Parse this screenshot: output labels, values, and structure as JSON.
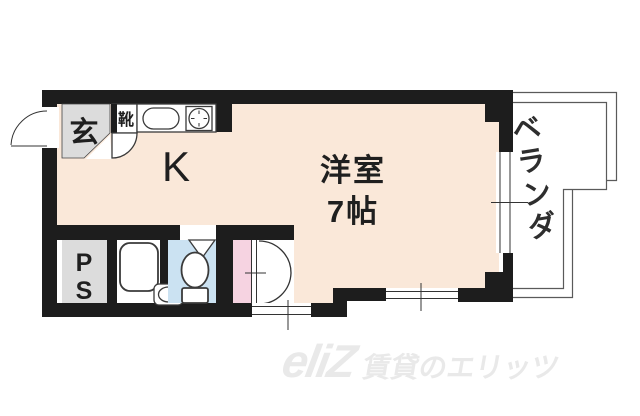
{
  "floor_plan": {
    "labels": {
      "entrance": "玄",
      "shoe_cabinet": "靴",
      "kitchen": "K",
      "main_room_name": "洋室",
      "main_room_size": "7帖",
      "veranda": "ベランダ",
      "pipe_space": {
        "line1": "P",
        "line2": "S"
      }
    },
    "colors": {
      "wall": "#1d1d1d",
      "floor": "#fae8d9",
      "service_gray": "#dcdcdc",
      "toilet_blue": "#cbe2f2",
      "closet_pink": "#f6d3e1",
      "outline": "#333333",
      "veranda_line": "#5a5a5a",
      "watermark": "#e9e9e9"
    },
    "icons": {
      "entrance_door": "quarter-arc-swing",
      "shoe_cabinet_door": "small-quarter-arc",
      "kitchen_sink": "rounded-oval-in-counter",
      "stove": "circle-in-square-with-ticks",
      "bathtub": "rounded-rectangle",
      "wash_basin": "oval-in-rounded-square",
      "toilet": "bowl-ellipse-with-tank",
      "toilet_door": "triangle-swing",
      "closet_door": "double-arc-fold",
      "window": "double-parallel-lines-with-tick"
    },
    "watermark": {
      "logo": "eliZ",
      "text": "賃貸のエリッツ"
    }
  }
}
